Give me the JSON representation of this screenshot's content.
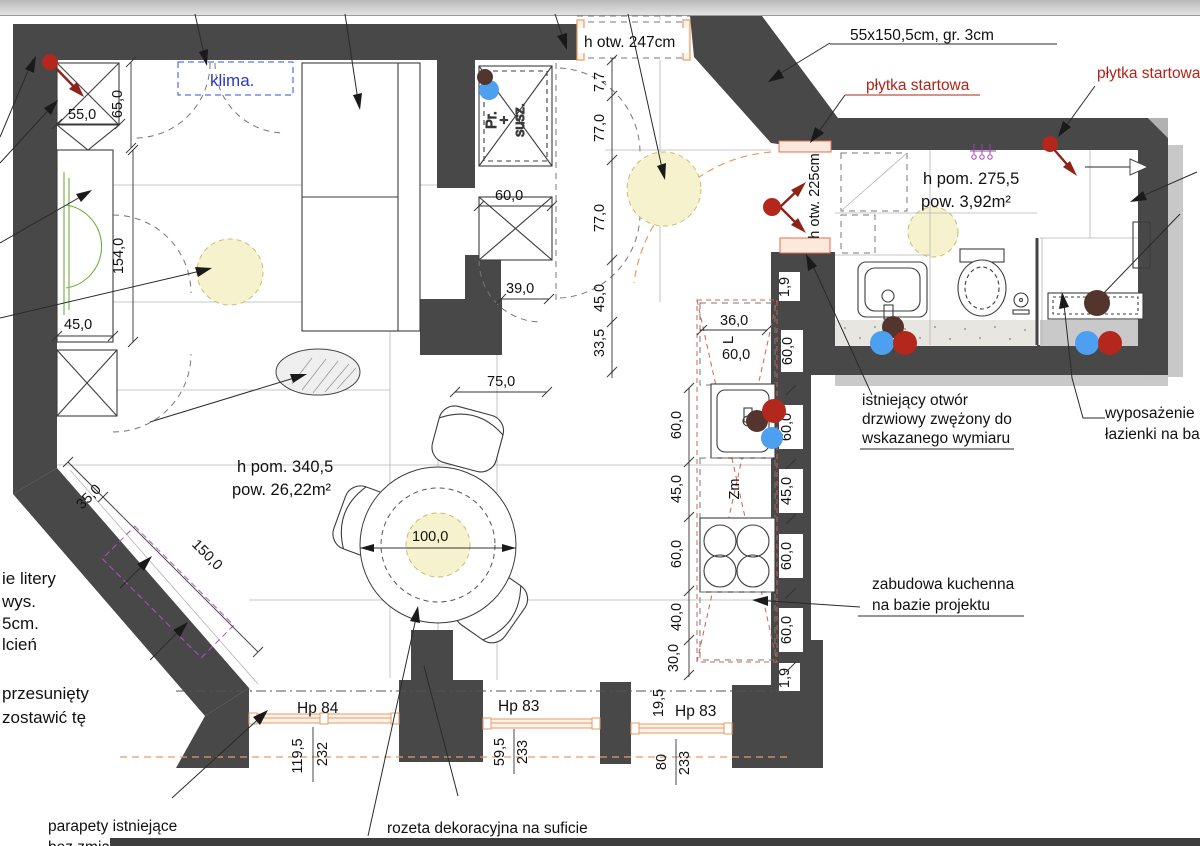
{
  "plan": {
    "rooms": {
      "living": {
        "height": "h pom. 340,5",
        "area": "pow. 26,22m²"
      },
      "bath": {
        "height": "h pom. 275,5",
        "area": "pow. 3,92m²"
      }
    },
    "annotations": {
      "klima": "klima.",
      "h_otw_247": "h otw. 247cm",
      "h_otw_225": "h otw. 225cm",
      "countertop": "55x150,5cm, gr. 3cm",
      "plytka_1": "płytka startowa",
      "plytka_2": "płytka startowa",
      "pr": "Pr.",
      "plus": "+",
      "susz": "susz.",
      "zm": "Zm",
      "l": "L",
      "istniejacy": [
        "istniejący otwór",
        "drzwiowy zwężony do",
        "wskazanego wymiaru"
      ],
      "wyposazenie": [
        "wyposażenie",
        "łazienki na ba"
      ],
      "zabudowa": [
        "zabudowa kuchenna",
        "na bazie projektu"
      ],
      "rozeta": "rozeta dekoracyjna na suficie",
      "parapety": [
        "parapety istniejące",
        "bez zmian"
      ],
      "cut_upper": [
        "ie litery",
        "wys.",
        "5cm.",
        "lcień"
      ],
      "cut_lower": [
        "przesunięty",
        "zostawić tę"
      ]
    },
    "dims": {
      "d55": "55,0",
      "d65": "65,0",
      "d154": "154,0",
      "d45": "45,0",
      "d35": "35,0",
      "d150": "150,0",
      "d100": "100,0",
      "d75": "75,0",
      "d39": "39,0",
      "d60": "60,0",
      "d36": "36,0",
      "d60b": "60,0",
      "d60c": "60,0",
      "d19a": "1,9",
      "d19_5": "19,5",
      "chain_mid": [
        "7,7",
        "77,0",
        "77,0",
        "45,0",
        "33,5"
      ],
      "kitchen_left": [
        "60,0",
        "45,0",
        "60,0",
        "40,0",
        "30,0"
      ],
      "kitchen_wall": [
        "60,0",
        "45,0",
        "60,0",
        "60,0",
        "1,9"
      ]
    },
    "windows": {
      "hp84": {
        "label": "Hp 84",
        "sill": "119,5",
        "height": "232"
      },
      "hp83a": {
        "label": "Hp 83",
        "sill": "59,5",
        "height": "233"
      },
      "hp83b": {
        "label": "Hp 83",
        "sill": "80",
        "height": "233"
      }
    }
  }
}
